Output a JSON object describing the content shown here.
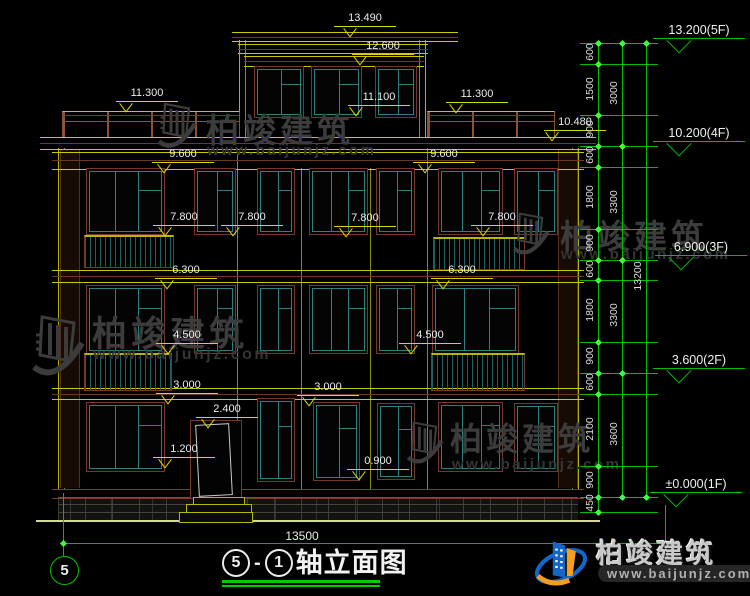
{
  "watermark": {
    "brand": "柏竣建筑",
    "url": "www.baijunjz.com"
  },
  "tags": [
    "13.490",
    "12.600",
    "11.300",
    "11.100",
    "11.300",
    "10.480",
    "9.600",
    "9.600",
    "7.800",
    "7.800",
    "7.800",
    "7.800",
    "6.300",
    "6.300",
    "4.500",
    "4.500",
    "3.000",
    "3.000",
    "2.400",
    "1.200",
    "0.900"
  ],
  "levels": [
    "13.200(5F)",
    "10.200(4F)",
    "6.900(3F)",
    "3.600(2F)",
    "±0.000(1F)"
  ],
  "chain": {
    "inner": [
      "600",
      "1500",
      "900",
      "600",
      "1800",
      "900",
      "600",
      "1800",
      "900",
      "600",
      "2100",
      "900",
      "450"
    ],
    "mid": [
      "3000",
      "3300",
      "3300",
      "3600"
    ],
    "total": "13200"
  },
  "footer": {
    "axis_bubble": "5",
    "width_dim": "13500",
    "title_axis_start": "5",
    "title_sep": "-",
    "title_axis_end": "1",
    "title_text": "轴立面图"
  }
}
